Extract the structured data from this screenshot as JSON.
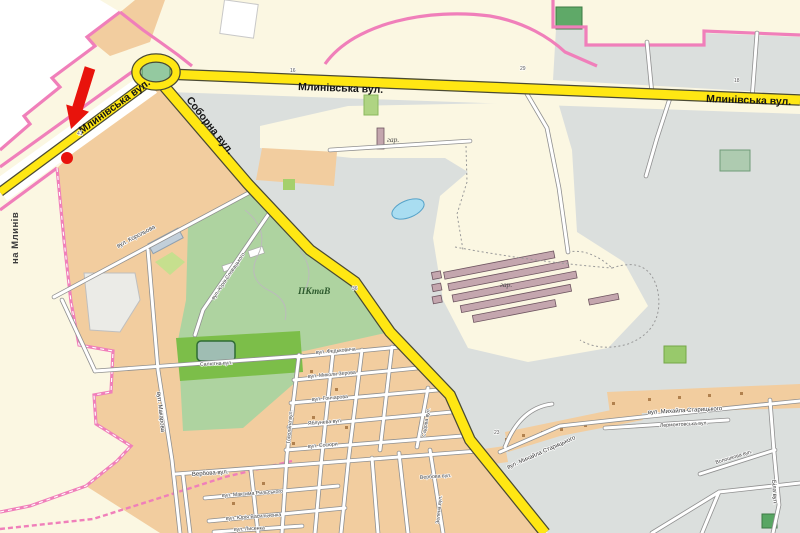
{
  "map": {
    "exit_label": "на Млинів",
    "major_road_labels": [
      {
        "id": "mlynivska-center",
        "text": "Млинівська вул."
      },
      {
        "id": "mlynivska-east",
        "text": "Млинівська вул."
      },
      {
        "id": "mlynivska-southwest",
        "text": "Млинівська вул."
      },
      {
        "id": "soborna",
        "text": "Соборна вул."
      }
    ],
    "street_labels": [
      {
        "id": "korolova",
        "text": "вул. Корольова"
      },
      {
        "id": "slovatskoho",
        "text": "вул. Юрія Словацького"
      },
      {
        "id": "saliutna",
        "text": "Салютна вул."
      },
      {
        "id": "makarova",
        "text": "вул. Макарова"
      },
      {
        "id": "fedkovycha",
        "text": "вул. Федьковича"
      },
      {
        "id": "zerova",
        "text": "вул. Миколи Зерова"
      },
      {
        "id": "honcharova",
        "text": "вул. Гончарова"
      },
      {
        "id": "yablyneva",
        "text": "Яблунева вул."
      },
      {
        "id": "sosiury",
        "text": "вул. Сосюри"
      },
      {
        "id": "verbova-west",
        "text": "Вербова вул."
      },
      {
        "id": "verbova-east",
        "text": "Вербова вул."
      },
      {
        "id": "rylskoho",
        "text": "вул. Максима Рильського"
      },
      {
        "id": "vasylchenka",
        "text": "вул. Юрія Васильченка"
      },
      {
        "id": "lysenka",
        "text": "вул. Лисенка"
      },
      {
        "id": "starytskoho-sw",
        "text": "вул. Михайла Старицького"
      },
      {
        "id": "starytskoho-e",
        "text": "вул. Михайла Старицького"
      },
      {
        "id": "lermontovska",
        "text": "Лермонтовська вул."
      },
      {
        "id": "voloshkova",
        "text": "Волошкова вул."
      },
      {
        "id": "bila",
        "text": "Біла вул."
      },
      {
        "id": "topolyna",
        "text": "Тополина вул."
      },
      {
        "id": "sadova",
        "text": "Садова вул."
      },
      {
        "id": "zelena",
        "text": "Зелена вул."
      }
    ],
    "area_labels": [
      {
        "id": "park",
        "text": "ПКтаВ"
      },
      {
        "id": "garage-n",
        "text": "гар."
      },
      {
        "id": "garage-c",
        "text": "гар."
      }
    ],
    "house_numbers": [
      "16",
      "29",
      "41",
      "18",
      "36",
      "23"
    ],
    "marker": {
      "type": "red arrow with dot",
      "color": "#E8130C"
    },
    "colors": {
      "background_cream": "#FBF7E2",
      "urban_tan": "#F2CD9F",
      "field_gray": "#DBDFDD",
      "park_green": "#AED3A0",
      "sports_green": "#7CBE49",
      "water_blue": "#A9DDF1",
      "road_major_yellow": "#FFE713",
      "road_minor_white": "#FFFFFF",
      "boundary_pink": "#F07FBA",
      "garage_mauve": "#C4A6AE",
      "marker_red": "#E8130C"
    }
  }
}
